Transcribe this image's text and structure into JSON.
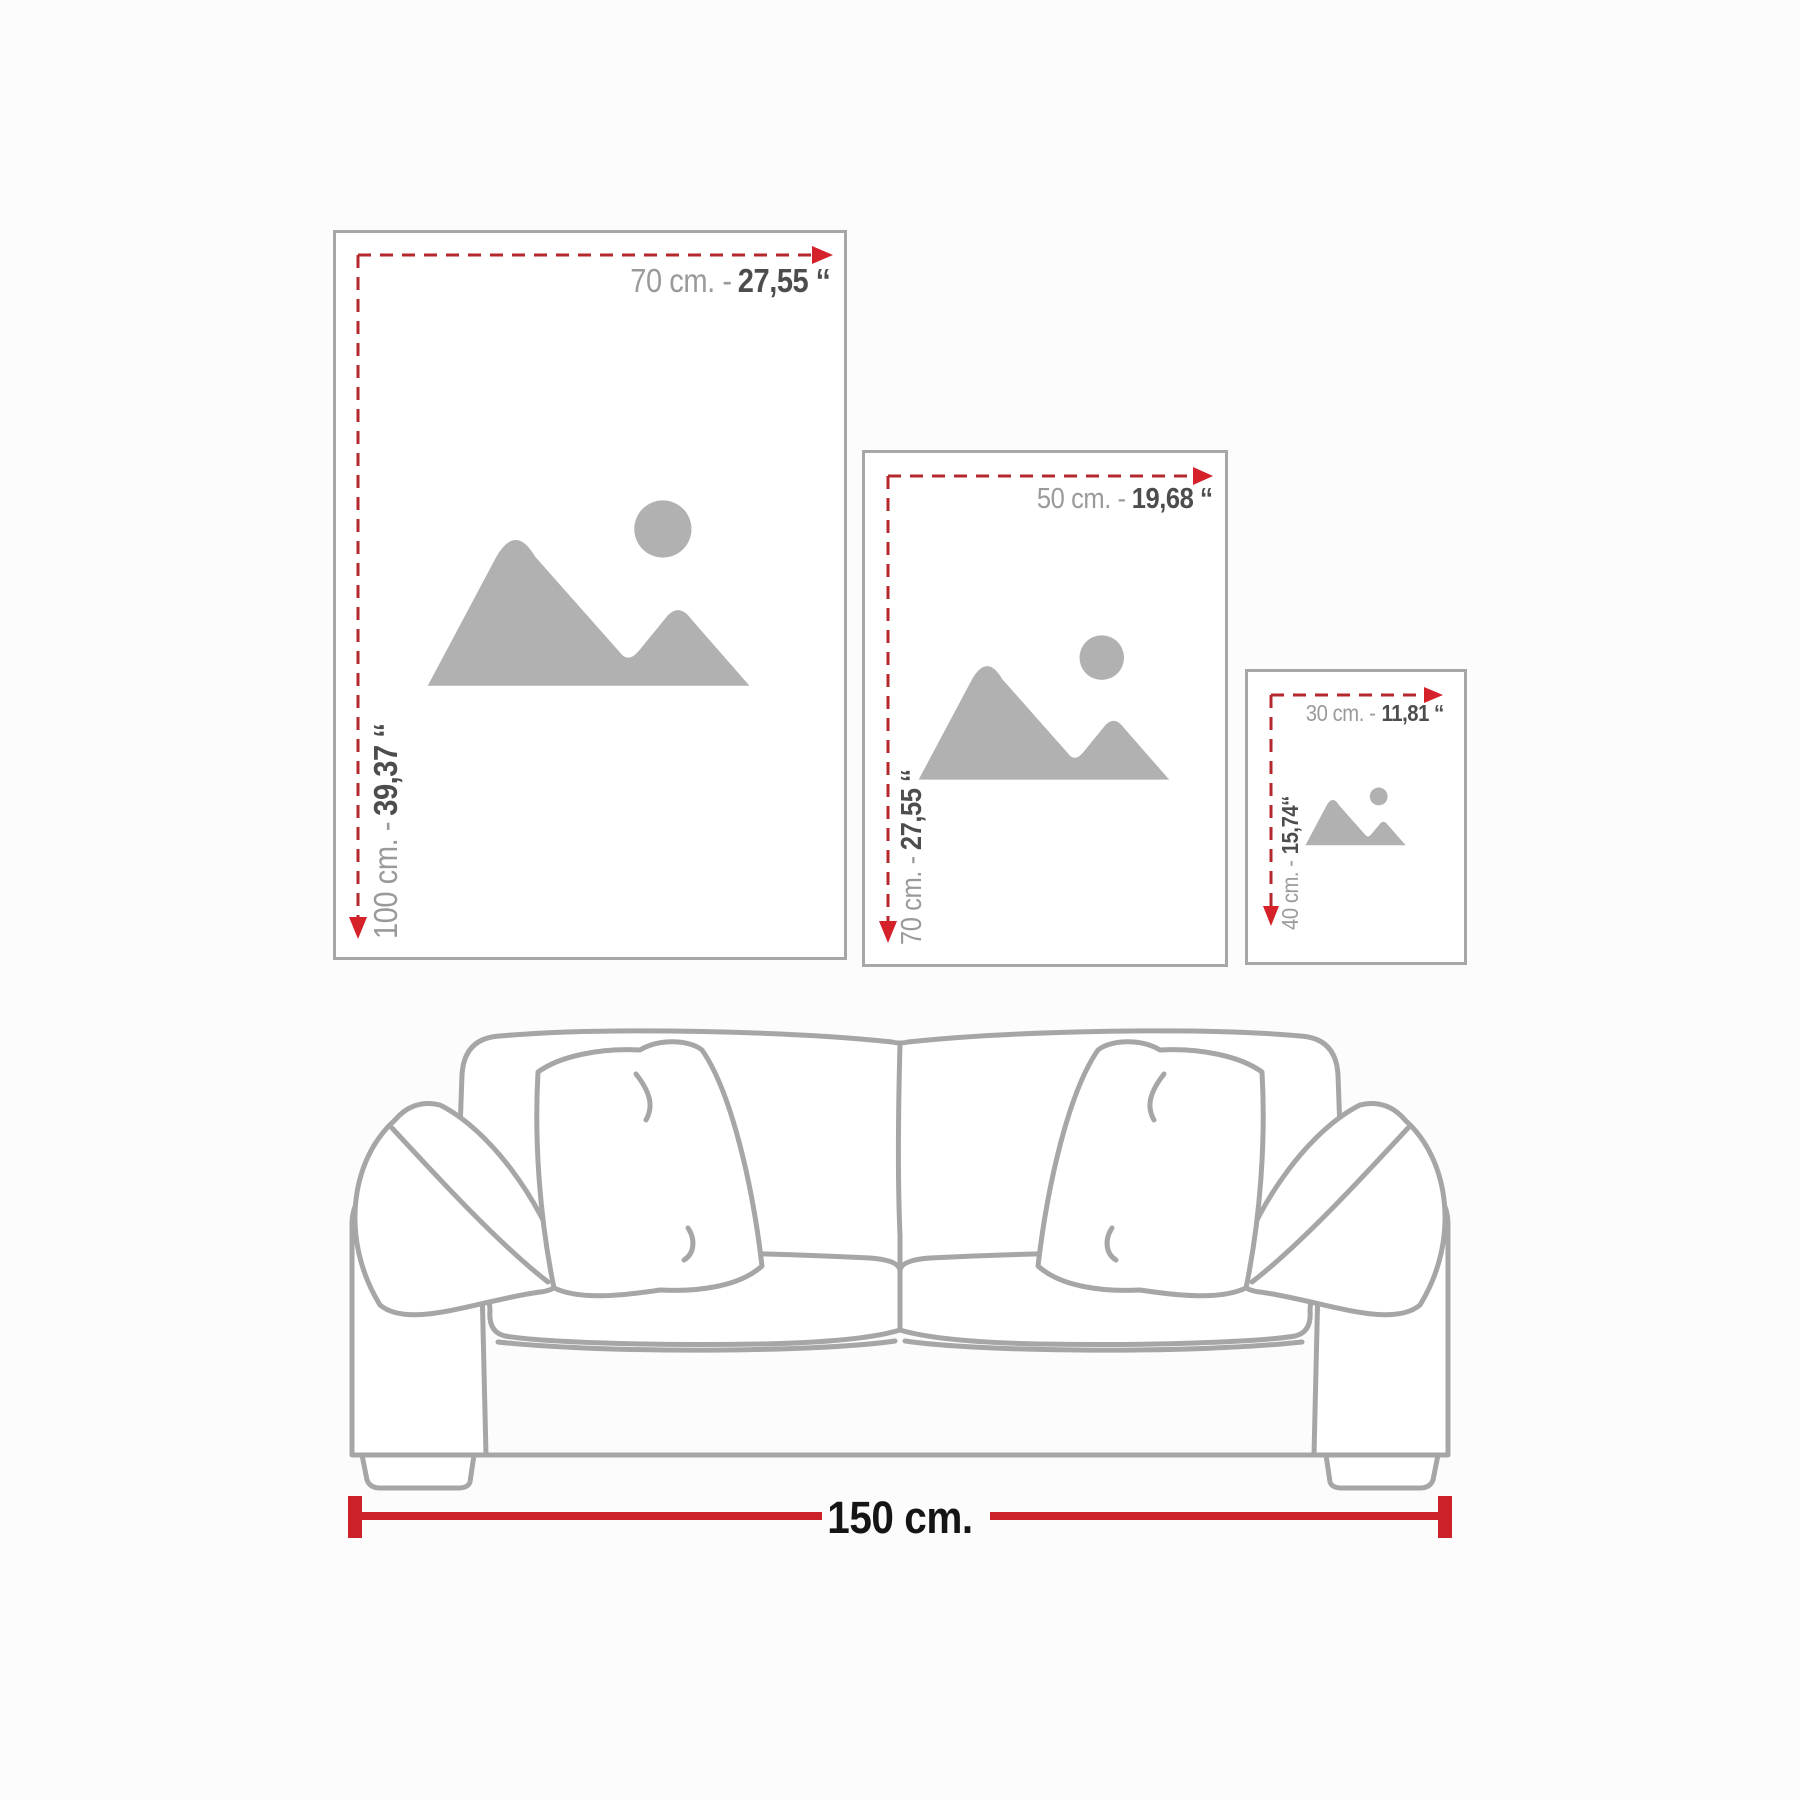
{
  "frames": [
    {
      "name": "large",
      "width_gray": "70 cm. -",
      "width_dark": "27,55 ‘‘",
      "height_gray": "100 cm. -",
      "height_dark": "39,37 ‘‘"
    },
    {
      "name": "medium",
      "width_gray": "50 cm. -",
      "width_dark": "19,68 ‘‘",
      "height_gray": "70 cm. -",
      "height_dark": "27,55 ‘‘"
    },
    {
      "name": "small",
      "width_gray": "30 cm. -",
      "width_dark": "11,81 ‘‘",
      "height_gray": "40 cm. -",
      "height_dark": "15,74‘‘"
    }
  ],
  "sofa": {
    "width_label": "150 cm."
  },
  "icons": {
    "placeholder": "image-placeholder-icon",
    "width_arrow": "dashed-arrow-right-icon",
    "height_arrow": "dashed-arrow-down-icon"
  },
  "colors": {
    "dash_red": "#b4282e",
    "arrow_red": "#d4212a",
    "measure_red": "#cc2128",
    "frame_border": "#a7a7a7",
    "label_gray": "#9a9a9a",
    "label_dark": "#4d4d4d",
    "icon_gray": "#b1b1b1",
    "sofa_line_gray": "#a6a6a6",
    "footer_text": "#151515"
  }
}
